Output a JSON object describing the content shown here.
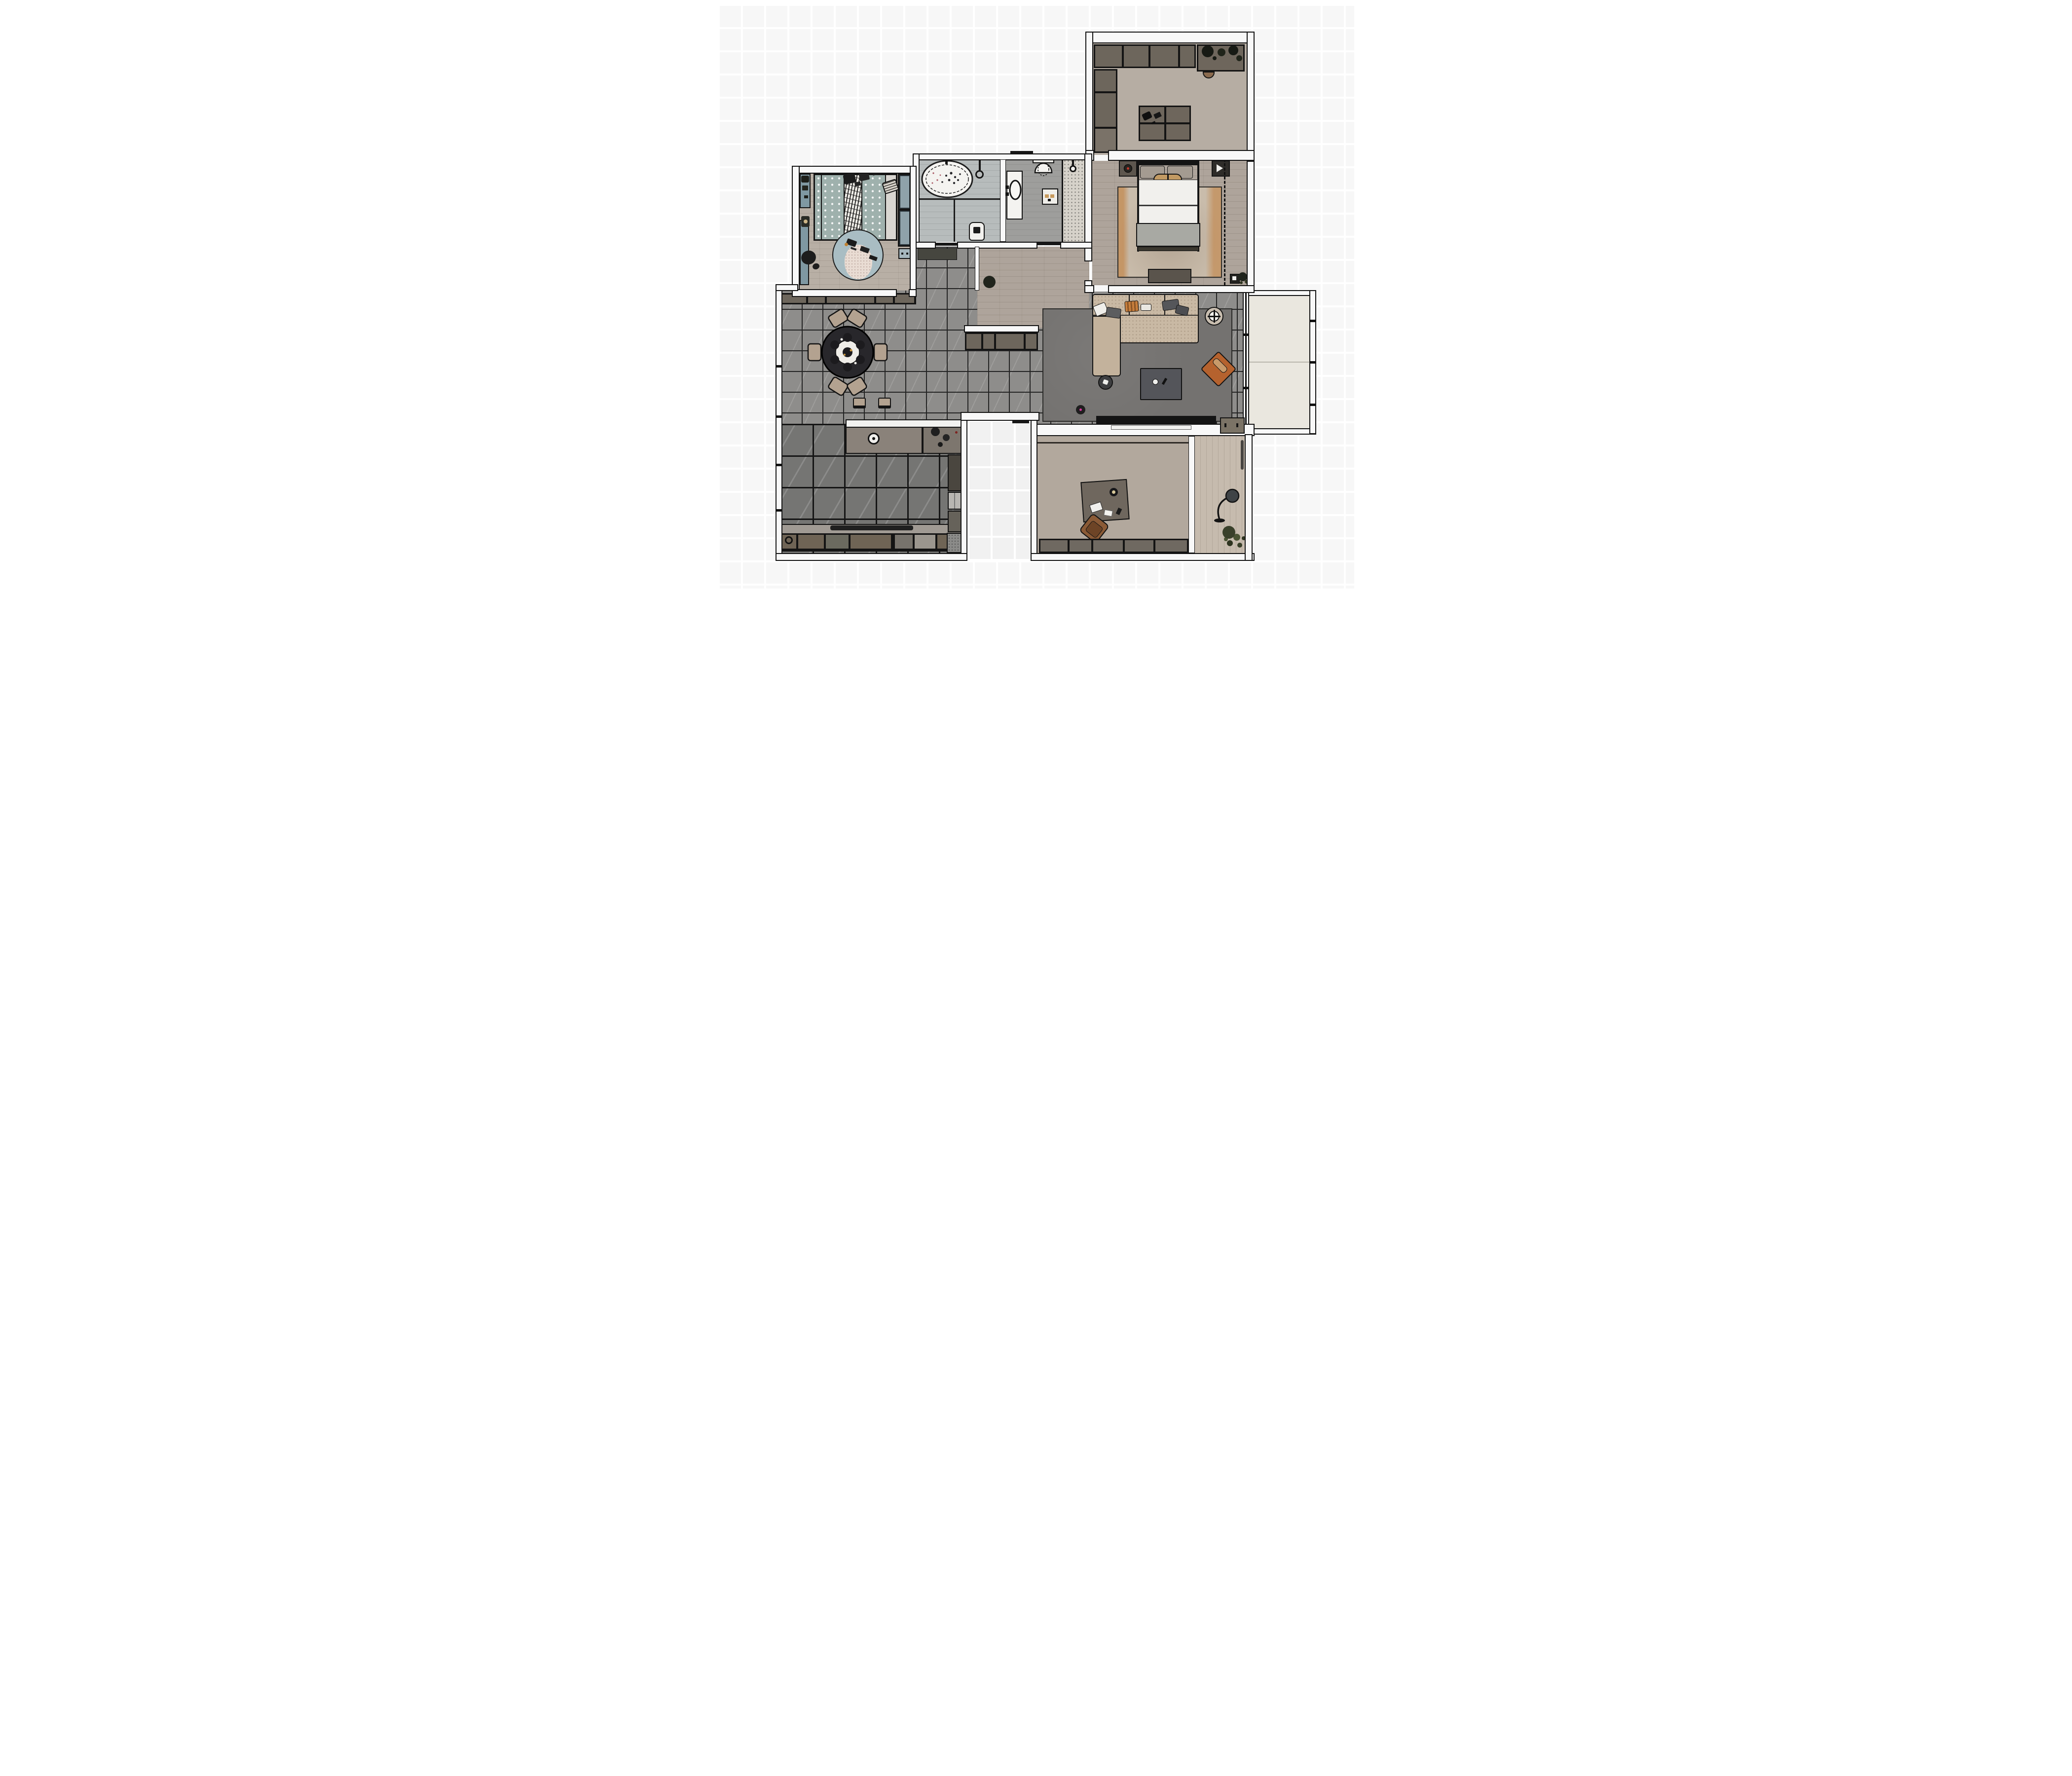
{
  "title": "2D rendered apartment floor plan, top-down view",
  "palette": {
    "background_grid": "#f1f1f1",
    "wall_fill": "#f8f8f8",
    "wall_outline": "#141414",
    "wood_floor": "#aea49b",
    "wood_floor_light": "#b8afa5",
    "loggia_wood": "#c6bbae",
    "tile_living_dining": "#8e8d8b",
    "tile_kitchen_dark": "#757573",
    "bathroom_floor": "#b7bcbc",
    "balcony_floor": "#eae7df",
    "living_rug": "#747270",
    "bedroom_rug": "#c9bcab",
    "bedroom_rug_accent_orange": "#c0762e",
    "sofa_beige": "#c9b9a4",
    "accent_chair_orange": "#b5622e",
    "cabinet_taupe": "#6d665c",
    "nursery_teal": "#9fb1ad",
    "nursery_blue": "#7f98a2",
    "wardrobe_panel_blue": "#8fa2aa",
    "fixture_white": "#f4f3f0",
    "vacuum_dot_magenta": "#d6399f",
    "nightstand_lamp_red": "#c03a2c"
  },
  "rooms": [
    {
      "id": "walk-in-closet",
      "label": "Walk-in closet",
      "floor": "light wood planks",
      "furniture": [
        "wardrobe run with hanging clothes",
        "corner planter with plants",
        "small bench stool",
        "side wardrobe column",
        "storage island dresser (4 compartments)"
      ]
    },
    {
      "id": "bedroom",
      "label": "Master bedroom",
      "floor": "wood planks",
      "furniture": [
        "double bed with white duvet and gray throw",
        "tan bolster cushion",
        "pillows",
        "left nightstand with red-accent lamp",
        "right nightstand",
        "distressed beige rug with orange streaks",
        "tv lowboard",
        "sliding wardrobe (dashed front)",
        "corner plant and frame"
      ]
    },
    {
      "id": "bathroom",
      "label": "Bathroom",
      "floor": "blue-gray planks",
      "furniture": [
        "freestanding oval bathtub with petals",
        "wall shower fixture",
        "washing machine"
      ]
    },
    {
      "id": "wc-shower",
      "label": "Toilet / shower room",
      "floor": "gray screed",
      "furniture": [
        "vanity with oval basin",
        "wall-hung toilet",
        "floor panel",
        "walk-in shower with terrazzo tray",
        "shower head",
        "door leaf"
      ]
    },
    {
      "id": "kids-room",
      "label": "Kids room / nursery",
      "floor": "light wood planks",
      "furniture": [
        "bed with teal dotted bedding and sheepskin throw",
        "toy cluster",
        "wardrobe with two blue panels",
        "drawer unit",
        "desk strip with task chair",
        "wall shelf with toys",
        "round play rug with pink center and toys"
      ]
    },
    {
      "id": "hallway",
      "label": "Hallway / corridor",
      "floor": "gray tile + wood",
      "furniture": [
        "dark door mat",
        "potted plant",
        "console sideboard"
      ]
    },
    {
      "id": "dining-area",
      "label": "Dining area",
      "floor": "gray marble tile",
      "furniture": [
        "round dining table with set plates",
        "six beige dining chairs",
        "sideboard cabinet row",
        "two bar stools"
      ]
    },
    {
      "id": "living-area",
      "label": "Living area",
      "floor": "gray marble tile",
      "furniture": [
        "beige corner sofa with chaise",
        "throw pillows (white, gray, orange striped)",
        "round side table",
        "dark coffee table",
        "orange accent armchair",
        "round pedestal table",
        "robot vacuum with magenta dot",
        "tv console with tv",
        "corner cabinet"
      ]
    },
    {
      "id": "kitchen",
      "label": "Kitchen",
      "floor": "dark marble tile",
      "furniture": [
        "island counter with round sink and cookware",
        "counter run with hood shelf",
        "base cabinet modules with burner module",
        "tall pantry unit",
        "refrigerator",
        "tall cabinet",
        "granite corner worktop"
      ]
    },
    {
      "id": "entry-nook",
      "label": "Entry nook (exterior notch)",
      "floor": "exterior",
      "furniture": [
        "entry door leaf"
      ]
    },
    {
      "id": "study",
      "label": "Study / office",
      "floor": "wood planks",
      "furniture": [
        "desk with lamp, laptop, papers and phone",
        "brown swivel chair",
        "low cabinet row"
      ]
    },
    {
      "id": "loggia",
      "label": "Reading loggia",
      "floor": "light wood planks",
      "furniture": [
        "arc floor lamp",
        "large potted plant"
      ]
    },
    {
      "id": "balcony",
      "label": "Balcony",
      "floor": "pale screed",
      "furniture": [
        "glazed window wall",
        "outer railing"
      ]
    }
  ]
}
